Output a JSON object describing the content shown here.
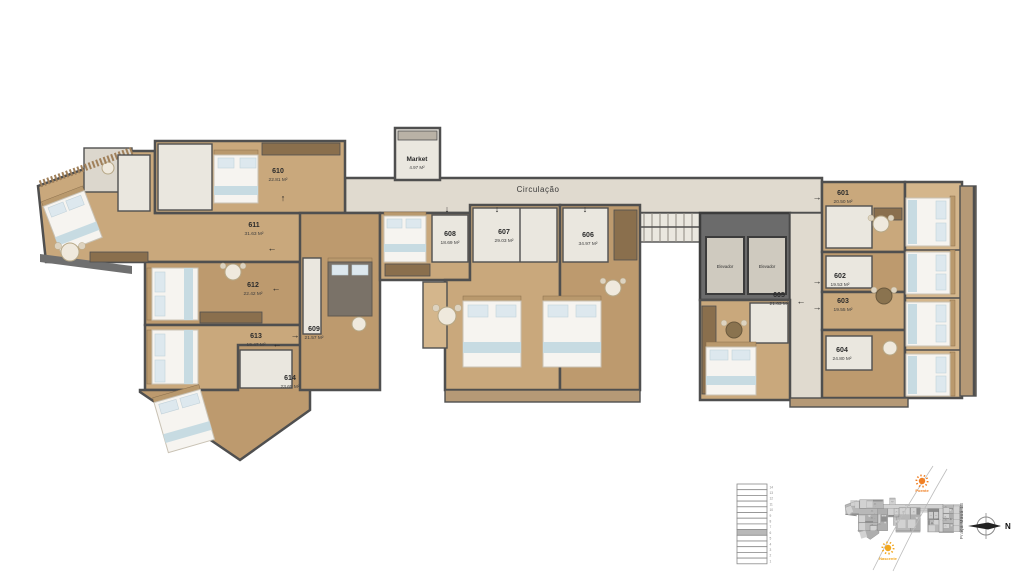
{
  "plan": {
    "corridor_label": "Circulação",
    "market_label": "Market",
    "market_area": "4.97 M²",
    "elevator_label": "Elevador",
    "units": [
      {
        "id": "601",
        "area": "20.50 M²"
      },
      {
        "id": "602",
        "area": "19.53 M²"
      },
      {
        "id": "603",
        "area": "19.55 M²"
      },
      {
        "id": "604",
        "area": "24.80 M²"
      },
      {
        "id": "605",
        "area": "21.63 M²"
      },
      {
        "id": "606",
        "area": "34.97 M²"
      },
      {
        "id": "607",
        "area": "29.03 M²"
      },
      {
        "id": "608",
        "area": "18.69 M²"
      },
      {
        "id": "609",
        "area": "21.57 M²"
      },
      {
        "id": "610",
        "area": "22.81 M²"
      },
      {
        "id": "611",
        "area": "31.63 M²"
      },
      {
        "id": "612",
        "area": "22.42 M²"
      },
      {
        "id": "613",
        "area": "19.47 M²"
      },
      {
        "id": "614",
        "area": "23.65 M²"
      }
    ]
  },
  "icons": {
    "arrow_up": "↑",
    "arrow_down": "↓",
    "arrow_left": "←",
    "arrow_right": "→"
  },
  "legend": {
    "street": "Praça Mauá 13",
    "north_label": "N",
    "sun_west": "Poente",
    "sun_east": "Nascente",
    "floors": [
      "14",
      "13",
      "12",
      "11",
      "10",
      "9",
      "8",
      "7",
      "6",
      "5",
      "4",
      "3",
      "2",
      "1"
    ],
    "highlighted_floor": "6"
  },
  "colors": {
    "wall": "#4f4f4f",
    "wood": "#c9a87c",
    "corridor": "#e0dacf",
    "tile": "#eae7df",
    "sun_west": "#f08025",
    "sun_east": "#f2a71f",
    "legend_highlight": "#b8b8b8"
  }
}
